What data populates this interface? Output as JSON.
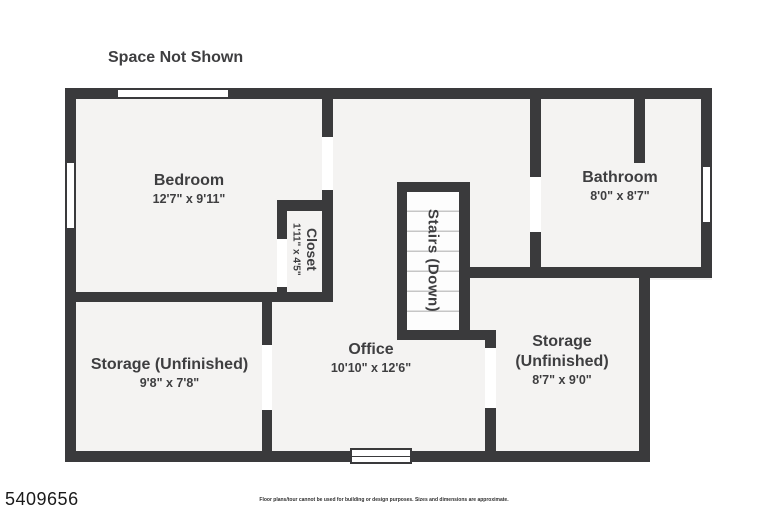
{
  "header": {
    "space_not_shown": "Space Not Shown"
  },
  "rooms": {
    "bedroom": {
      "name": "Bedroom",
      "dims": "12'7\" x 9'11\""
    },
    "closet": {
      "name": "Closet",
      "dims": "1'11\" x 4'5\""
    },
    "stairs": {
      "name": "Stairs (Down)"
    },
    "bathroom": {
      "name": "Bathroom",
      "dims": "8'0\" x 8'7\""
    },
    "storage_left": {
      "name": "Storage (Unfinished)",
      "dims": "9'8\" x 7'8\""
    },
    "office": {
      "name": "Office",
      "dims": "10'10\" x 12'6\""
    },
    "storage_right": {
      "name": "Storage (Unfinished)",
      "dims": "8'7\" x 9'0\""
    }
  },
  "footer": {
    "listing_id": "5409656",
    "disclaimer": "Floor plans/tour cannot be used for building or design purposes. Sizes and dimensions are approximate."
  },
  "colors": {
    "wall": "#3a3a3c",
    "floor": "#f4f3f2",
    "text": "#3e3e40",
    "stair_line": "#c6c6c6"
  }
}
